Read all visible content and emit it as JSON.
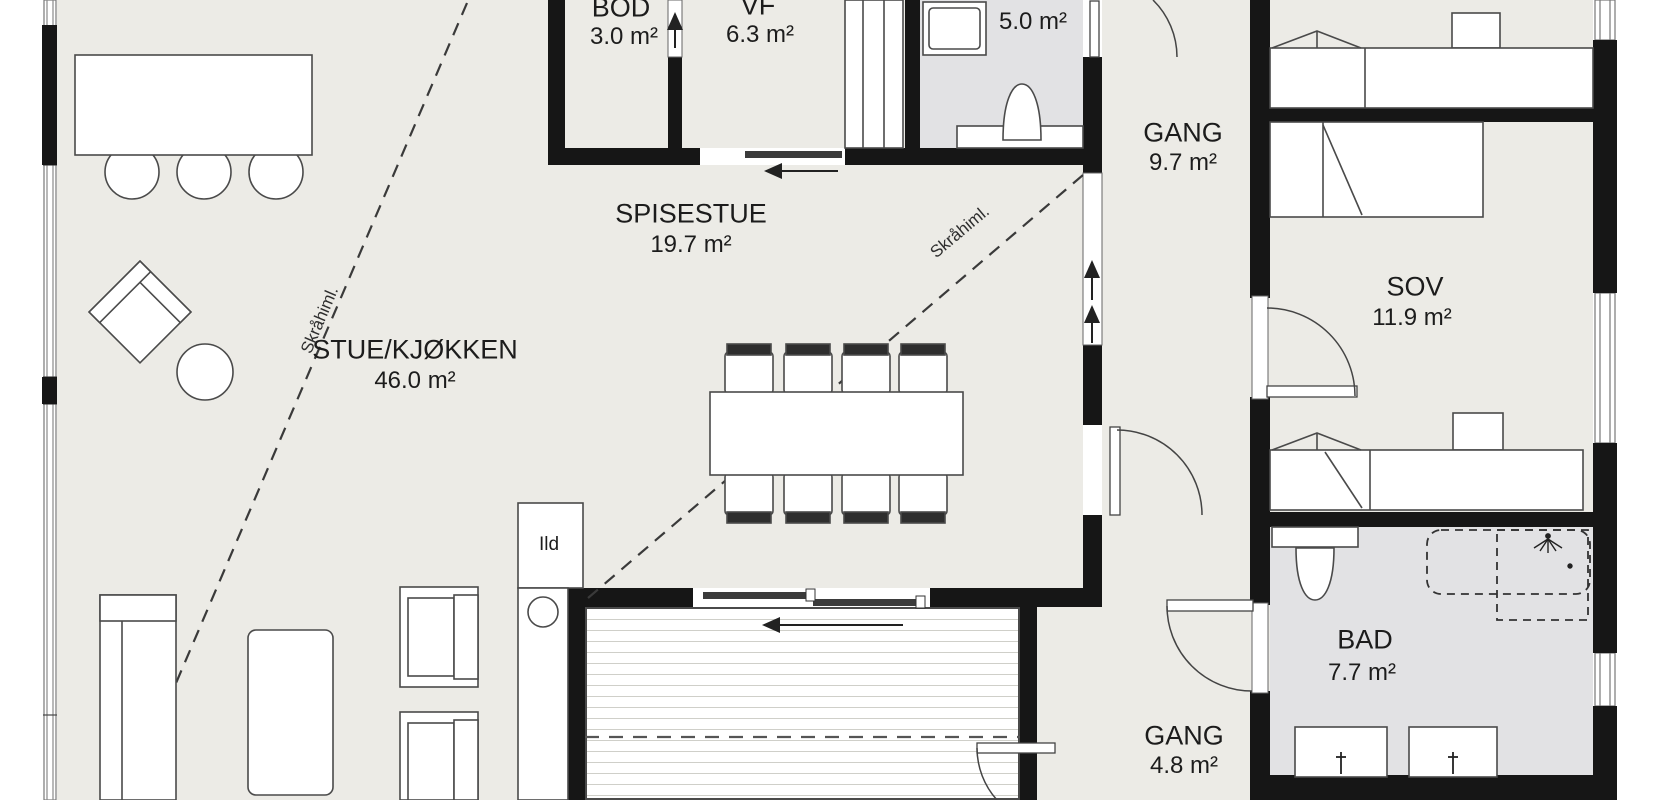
{
  "rooms": [
    {
      "name": "STUE/KJØKKEN",
      "area": "46.0 m²"
    },
    {
      "name": "SPISESTUE",
      "area": "19.7 m²"
    },
    {
      "name": "BOD",
      "area": "3.0 m²"
    },
    {
      "name": "VF",
      "area": "6.3 m²"
    },
    {
      "name": "BAD",
      "area": "5.0 m²"
    },
    {
      "name": "GANG",
      "area": "9.7 m²"
    },
    {
      "name": "SOV",
      "area": "11.9 m²"
    },
    {
      "name": "BAD",
      "area": "7.7 m²"
    },
    {
      "name": "GANG",
      "area": "4.8 m²"
    }
  ],
  "annotations": {
    "fireplace": "Ild",
    "sloped_ceiling": "Skråhiml."
  },
  "colors": {
    "wall": "#161616",
    "floor": "#ECEBE6",
    "bath_floor": "#E2E2E4",
    "furniture_outline": "#4a4a4a",
    "chair_back": "#2e2e2e",
    "deck_plank_line": "#cfcfc9"
  }
}
